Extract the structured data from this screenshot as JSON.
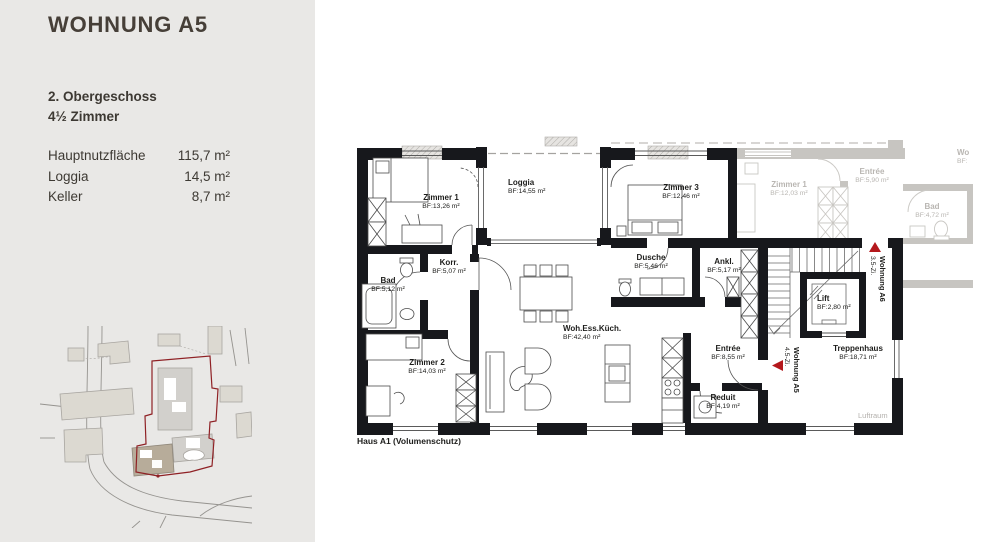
{
  "sidebar": {
    "title": "WOHNUNG A5",
    "floor": "2. Obergeschoss",
    "rooms": "4½ Zimmer",
    "metrics": [
      {
        "label": "Hauptnutzfläche",
        "value": "115,7 m²"
      },
      {
        "label": "Loggia",
        "value": "14,5 m²"
      },
      {
        "label": "Keller",
        "value": "8,7 m²"
      }
    ]
  },
  "plan": {
    "rooms": {
      "zimmer1": {
        "name": "Zimmer 1",
        "area": "BF:13,26 m²"
      },
      "loggia": {
        "name": "Loggia",
        "area": "BF:14,55 m²"
      },
      "zimmer3": {
        "name": "Zimmer 3",
        "area": "BF:12,46 m²"
      },
      "korr": {
        "name": "Korr.",
        "area": "BF:5,07 m²"
      },
      "bad": {
        "name": "Bad",
        "area": "BF:5,12 m²"
      },
      "dusche": {
        "name": "Dusche",
        "area": "BF:5,46 m²"
      },
      "ankl": {
        "name": "Ankl.",
        "area": "BF:5,17 m²"
      },
      "wohnen": {
        "name": "Woh.Ess.Küch.",
        "area": "BF:42,40 m²"
      },
      "zimmer2": {
        "name": "Zimmer 2",
        "area": "BF:14,03 m²"
      },
      "entree": {
        "name": "Entrée",
        "area": "BF:8,55 m²"
      },
      "reduit": {
        "name": "Reduit",
        "area": "BF:4,19 m²"
      },
      "lift": {
        "name": "Lift",
        "area": "BF:2,80 m²"
      },
      "treppenhaus": {
        "name": "Treppenhaus",
        "area": "BF:18,71 m²"
      }
    },
    "neighbor_rooms": {
      "zimmer1": {
        "name": "Zimmer 1",
        "area": "BF:12,03 m²"
      },
      "entree": {
        "name": "Entrée",
        "area": "BF:5,90 m²"
      },
      "bad": {
        "name": "Bad",
        "area": "BF:4,72 m²"
      },
      "cut": {
        "name": "Wo",
        "area": "BF:"
      }
    },
    "markers": {
      "a5": {
        "title": "Wohnung A5",
        "subtitle": "4.5-Zi."
      },
      "a6": {
        "title": "Wohnung A6",
        "subtitle": "3.5-Zi."
      }
    },
    "footnote": "Haus A1 (Volumenschutz)",
    "luftraum": "Luftraum"
  },
  "colors": {
    "accent_red": "#b4181c",
    "boundary_red": "#8f2125",
    "wall": "#17181c",
    "faded": "#b9b6b2",
    "background": "#e9e8e6"
  }
}
